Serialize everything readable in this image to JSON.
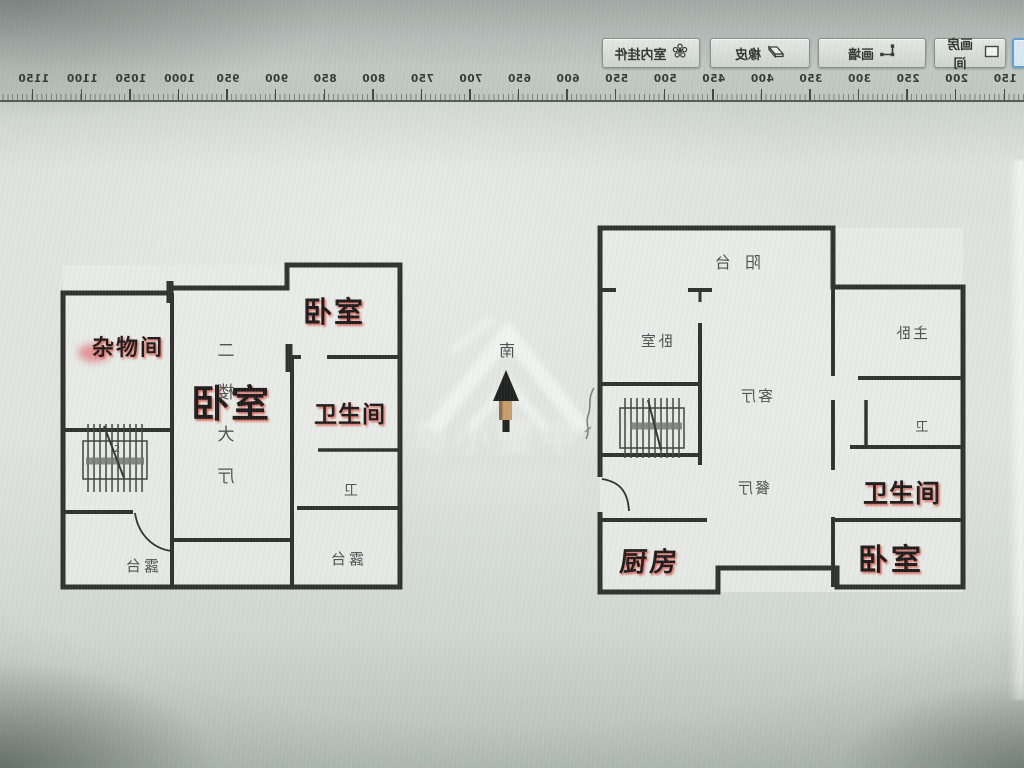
{
  "toolbar": {
    "partial_button_label": "字",
    "buttons": [
      {
        "name": "draw-room",
        "label": "画房间"
      },
      {
        "name": "draw-wall",
        "label": "画墙"
      },
      {
        "name": "eraser",
        "label": "橡皮"
      },
      {
        "name": "indoor-items",
        "label": "室内挂件"
      }
    ]
  },
  "ruler": {
    "unit_min": 150,
    "unit_max": 1150,
    "step": 50,
    "values": [
      150,
      200,
      250,
      300,
      350,
      400,
      450,
      500,
      550,
      600,
      650,
      700,
      750,
      800,
      850,
      900,
      950,
      1000,
      1050,
      1100,
      1150
    ]
  },
  "canvas": {
    "compass_south_label": "南",
    "watermark_text": "与小壁中"
  },
  "plan_left": {
    "annotations": {
      "storage": "杂物间",
      "bedroom_main": "卧室",
      "bedroom_top": "卧室",
      "bathroom": "卫生间"
    },
    "cad_labels": {
      "hall_vertical": "二楼大厅",
      "terrace_left": "露台",
      "terrace_right": "露台",
      "wc": "卫",
      "stair_number": "2"
    }
  },
  "plan_right": {
    "annotations": {
      "kitchen": "厨房",
      "bathroom": "卫生间",
      "bedroom": "卧室"
    },
    "cad_labels": {
      "balcony": "阳台",
      "bedroom_small": "卧室",
      "master": "主卧",
      "living": "客厅",
      "dining": "餐厅",
      "wc": "卫"
    }
  },
  "colors": {
    "wall": "#2a2c2a",
    "annotation_glow": "#cf3a2e",
    "selected_button_border": "#5b9bd5",
    "arrow_shaft": "#c59a66"
  }
}
